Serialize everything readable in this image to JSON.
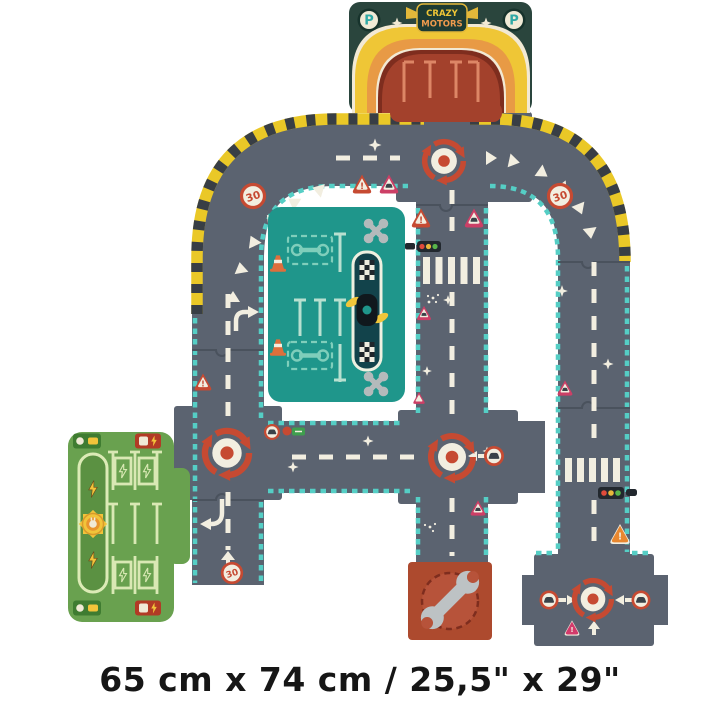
{
  "caption": "65 cm x 74 cm / 25,5\" x 29\"",
  "brand": {
    "line1": "CRAZY",
    "line2": "MOTORS"
  },
  "garage": {
    "parking_letter": "P"
  },
  "signs": {
    "speed_limit": "30",
    "exclamation": "!"
  },
  "colors": {
    "road": "#5b6370",
    "teal_border": "#55cec5",
    "hazard_yellow": "#eac827",
    "hazard_dark": "#383e45",
    "marking_cream": "#f2eee0",
    "accent_red": "#c64a32",
    "pink_sign": "#cc3f66",
    "orange_sign": "#e8872f",
    "service_garage_teal": "#1f968b",
    "charging_station_green": "#69a14f",
    "repair_piece_red": "#ad4a2e",
    "garage_header_green": "#2a453d",
    "garage_arch_red": "#a3412c"
  },
  "icons": [
    "roundabout-icon",
    "speed-limit-sign",
    "warning-sign",
    "car-sign",
    "traffic-light-icon",
    "crosswalk",
    "wrench-icon",
    "crossed-wrenches-icon",
    "checkered-flag",
    "tire-icon",
    "traffic-cone-icon",
    "sun-plug-icon",
    "lightning-bolt-icon",
    "charger-icon",
    "rainbow-arch",
    "parking-badge",
    "brand-shield",
    "sparkle-icon"
  ]
}
